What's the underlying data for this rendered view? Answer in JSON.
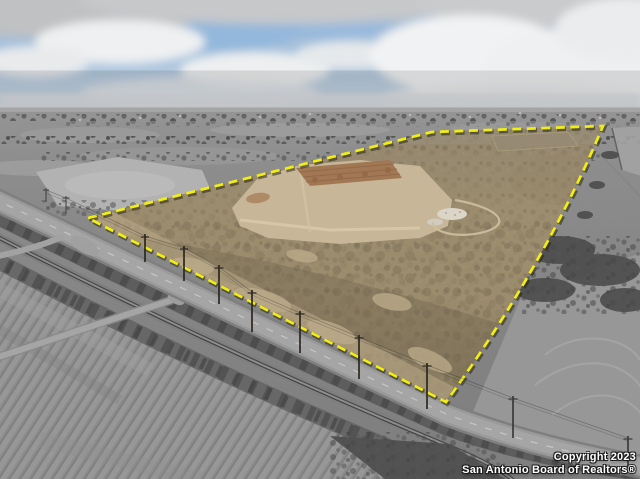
{
  "scene": {
    "type": "aerial-drone-photo",
    "subject": "rural land parcel highlighted in color with yellow dashed boundary over desaturated surroundings",
    "boundary_color": "#f2ee14"
  },
  "watermark": {
    "line1": "Copyright 2023",
    "line2": "San Antonio Board of Realtors®"
  }
}
